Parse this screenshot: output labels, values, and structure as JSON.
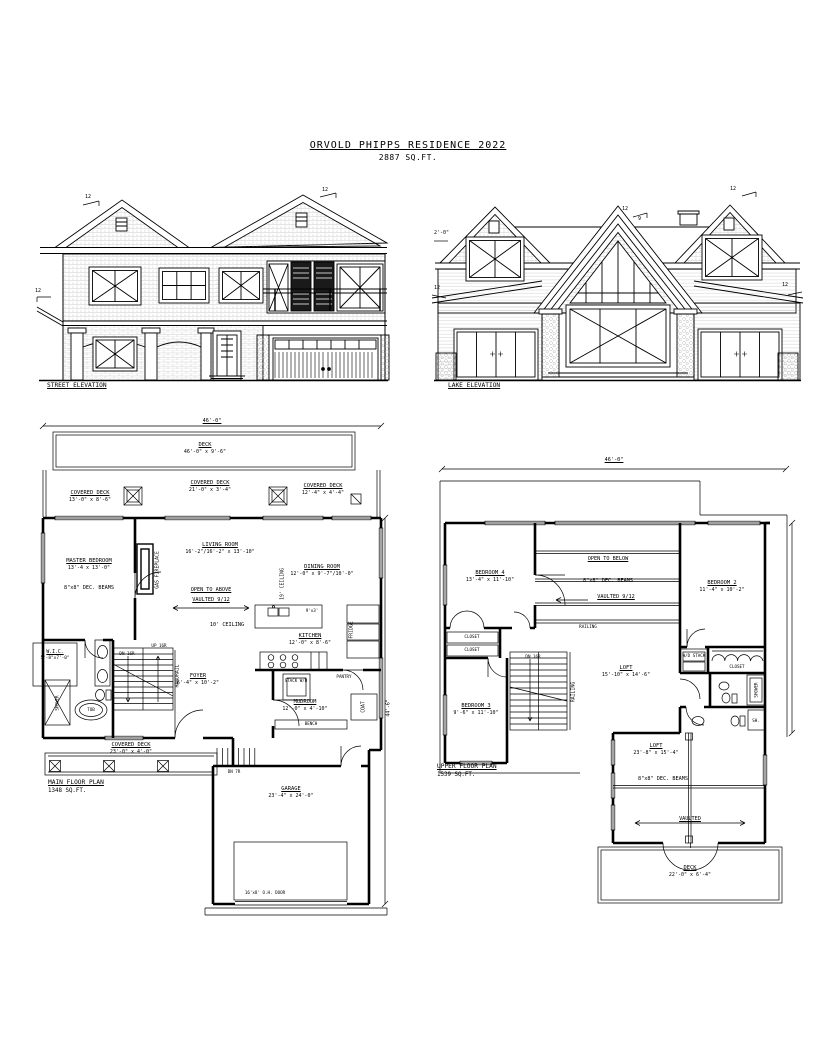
{
  "sheet": {
    "title": "ORVOLD PHIPPS RESIDENCE 2022",
    "total_area": "2887 SQ.FT."
  },
  "street_elevation": {
    "caption": "STREET ELEVATION",
    "pitch_left_gable": "12",
    "pitch_right_gable": "12",
    "pitch_side": "12"
  },
  "lake_elevation": {
    "caption": "LAKE ELEVATION",
    "pitch_center_run": "12",
    "pitch_center_rise": "9",
    "pitch_right_gable": "12",
    "pitch_left_shed": "12",
    "pitch_right_shed": "12",
    "overhang": "2'-0\""
  },
  "main_floor": {
    "caption": "MAIN FLOOR PLAN",
    "area": "1348 SQ.FT.",
    "width_dim": "46'-0\"",
    "depth_dim": "44'-6\"",
    "deck": {
      "name": "DECK",
      "dims": "46'-0\" x 9'-6\""
    },
    "covered_deck_left": {
      "name": "COVERED DECK",
      "dims": "13'-0\" x 8'-6\""
    },
    "covered_deck_mid": {
      "name": "COVERED DECK",
      "dims": "21'-0\" x 3'-4\""
    },
    "covered_deck_right": {
      "name": "COVERED DECK",
      "dims": "12'-4\" x 4'-4\""
    },
    "master_bedroom": {
      "name": "MASTER BEDROOM",
      "dims": "13'-4 x 13'-0\""
    },
    "beams_note": "8\"x8\" DEC. BEAMS",
    "gas_fireplace": "GAS FIREPLACE",
    "living_room": {
      "name": "LIVING ROOM",
      "dims": "16'-2\"/16'-2\" x 13'-10\""
    },
    "open_to_above": "OPEN TO ABOVE",
    "vaulted": "VAULTED 9/12",
    "ceiling_10": "10' CEILING",
    "ceiling_19": "19' CEILING",
    "dining_room": {
      "name": "DINING ROOM",
      "dims": "12'-0\" x 9'-7\"/10'-0\""
    },
    "kitchen": {
      "name": "KITCHEN",
      "dims": "12'-0\" x 8'-6\""
    },
    "island": "9'x3'",
    "fridge": "FRIDGE",
    "pantry": "PANTRY",
    "stack_wd": "STACK W/D",
    "mudroom": {
      "name": "MUDROOM",
      "dims": "12'-0\" x 4'-10\""
    },
    "bench": "BENCH",
    "coat": "COAT",
    "foyer": {
      "name": "FOYER",
      "dims": "6'-4\" x 10'-2\""
    },
    "handrail": "HANDRAIL",
    "up_stairs": "UP 16R",
    "dn_stairs": "DN 16R",
    "wic": {
      "name": "W.I.C.",
      "dims": "5'-8\"x7'-0\""
    },
    "shower": "SHOWER",
    "tub": "TUB",
    "covered_deck_front": {
      "name": "COVERED DECK",
      "dims": "23'-0\" x 4'-0\""
    },
    "dn_garage": "DN 7R",
    "garage": {
      "name": "GARAGE",
      "dims": "23'-4\" x 24'-0\""
    },
    "oh_door": "16'x8' O.H. DOOR"
  },
  "upper_floor": {
    "caption": "UPPER FLOOR PLAN",
    "area": "1539 SQ.FT.",
    "width_dim": "46'-0\"",
    "bedroom_4": {
      "name": "BEDROOM 4",
      "dims": "13'-4\" x 11'-10\""
    },
    "open_to_below": "OPEN TO BELOW",
    "beams_note": "8\"x8\" DEC. BEAMS",
    "vaulted": "VAULTED 9/12",
    "railing": "RAILING",
    "stair_railing": "RAILING",
    "bedroom_2": {
      "name": "BEDROOM 2",
      "dims": "11'-4\" x 10'-2\""
    },
    "wd_stack": "W/D STACK",
    "closet_bed2": "CLOSET",
    "shower": "SHOWER",
    "sh": "SH.",
    "closet_a": "CLOSET",
    "closet_b": "CLOSET",
    "dn_stairs": "DN 16R",
    "bedroom_3": {
      "name": "BEDROOM 3",
      "dims": "9'-6\" x 11'-10\""
    },
    "loft": {
      "name": "LOFT",
      "dims": "15'-10\" x 14'-6\""
    },
    "loft_lower": {
      "name": "LOFT",
      "dims": "23'-8\" x 15'-4\""
    },
    "beams_note_2": "8\"x8\" DEC. BEAMS",
    "vaulted_2": "VAULTED",
    "deck": {
      "name": "DECK",
      "dims": "22'-0\" x 6'-4\""
    }
  }
}
